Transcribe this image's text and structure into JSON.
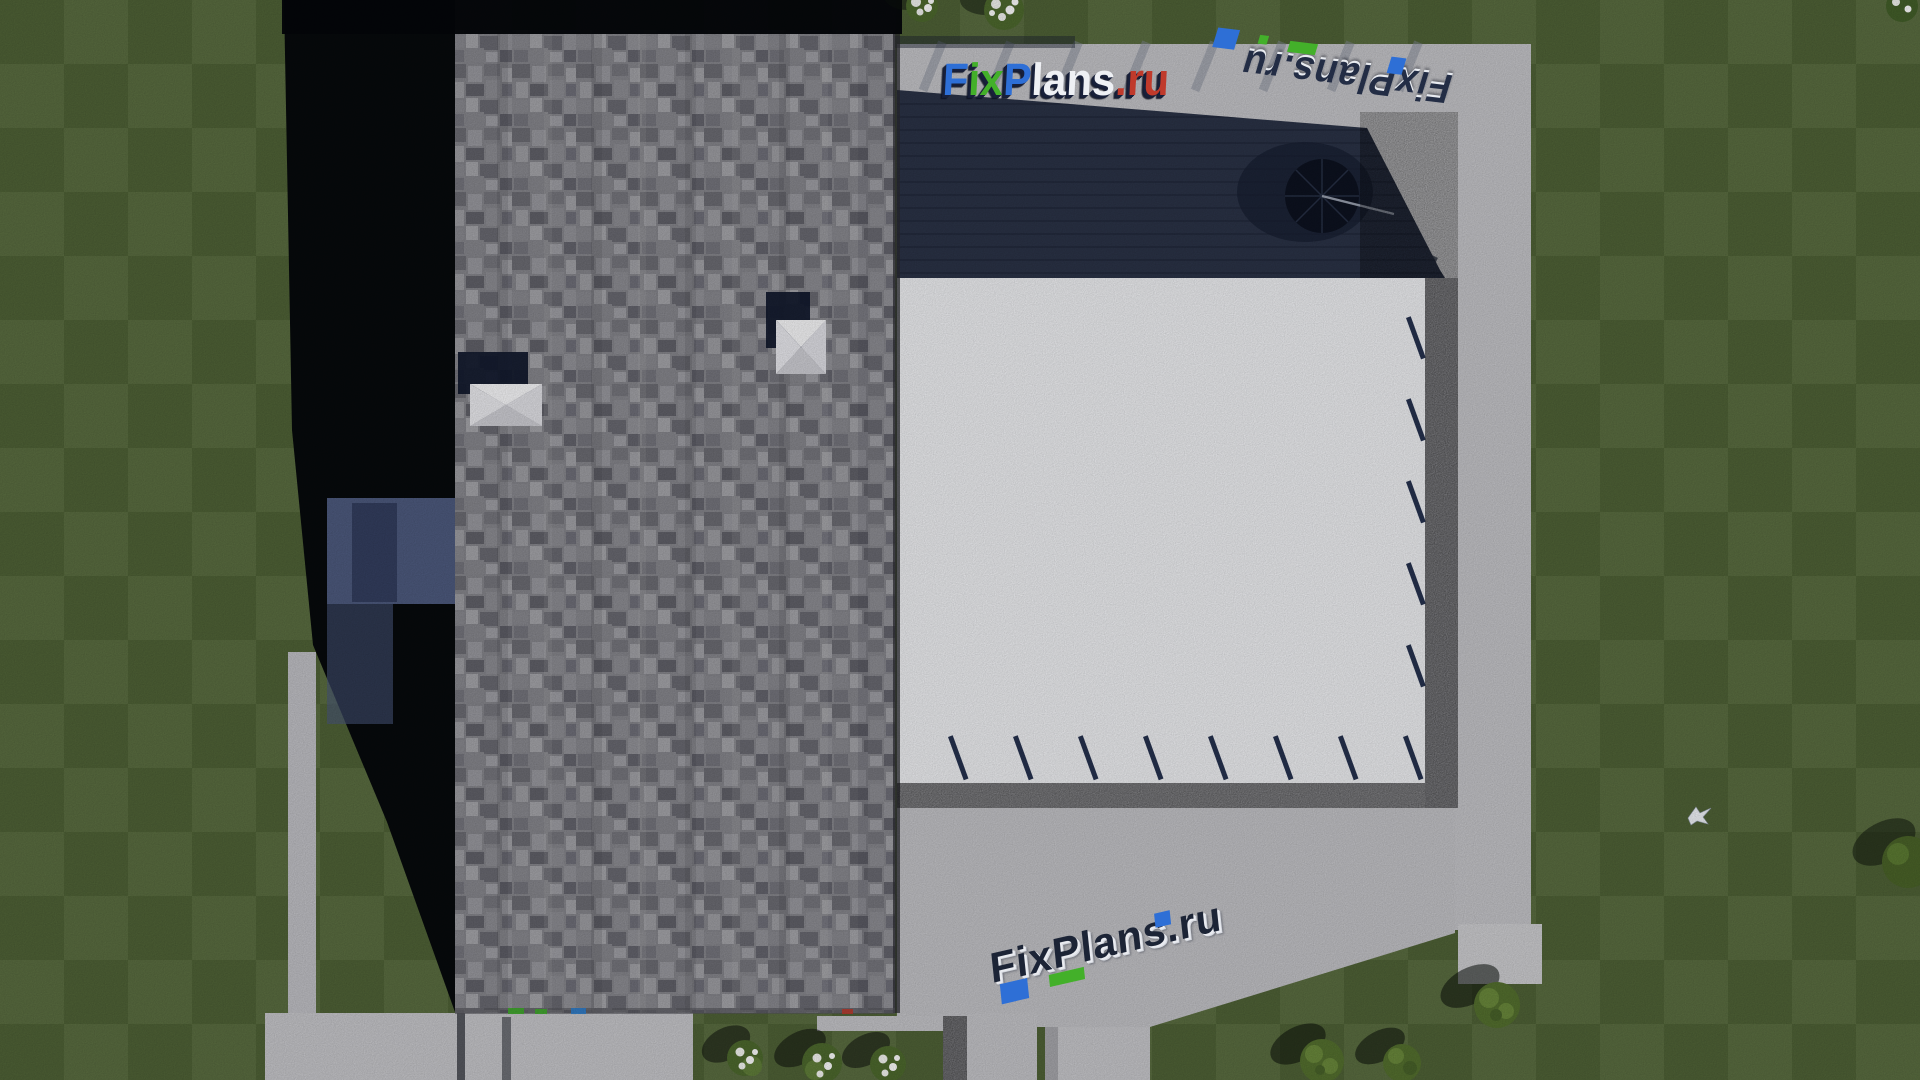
{
  "scene": {
    "type": "aerial-3d-render",
    "description": "Top-down 3D architectural render of a house: gray shingle roof, white terrace, pergola-shaded deck with patio umbrella, concrete paths and patio, striped mowed lawn, bushes and a flying bird",
    "watermarks": {
      "top": {
        "text": "FixPlans.ru",
        "segments": [
          {
            "text": "F",
            "color": "#2e6fd6"
          },
          {
            "text": "ix",
            "color": "#43b02a"
          },
          {
            "text": "P",
            "color": "#2e6fd6"
          },
          {
            "text": "lans",
            "color": "#eef0f4"
          },
          {
            "text": ".ru",
            "color": "#c03a2b"
          }
        ]
      },
      "top_right_mirrored": {
        "text": "FixPlans.ru",
        "color": "#232d45",
        "style": "upside-down 3D reflection, navy with blue and green accent blocks"
      },
      "bottom": {
        "text": "FixPlans.ru",
        "color": "#1c2436",
        "style": "tilted navy 3D letters with white faces, blue and green accent blocks"
      }
    },
    "palette": {
      "grass": "#55693a",
      "grass_dark": "#4c5f33",
      "concrete": "#c6c6ca",
      "concrete_light": "#d2d2d5",
      "terrace_white": "#f0f1f4",
      "roof_gray": "#87878d",
      "shadow_black": "#04060a",
      "pergola_navy": "#2b3347",
      "gravel": "#aeaeb3",
      "accent_blue": "#2e6fd6",
      "accent_green": "#43b02a",
      "accent_red": "#c03a2b",
      "navy": "#18203a"
    },
    "objects": [
      {
        "name": "house-roof",
        "desc": "gray asphalt-shingle roof, rectangular, top view",
        "count": 1
      },
      {
        "name": "roof-vent-skylight",
        "desc": "white pyramid roof vents with navy cast shadows",
        "count": 2
      },
      {
        "name": "white-terrace",
        "desc": "white stucco terrace with navy joist shadows on edges",
        "count": 1
      },
      {
        "name": "pergola-shaded-deck",
        "desc": "dark navy shaded deck area at top of terrace",
        "count": 1
      },
      {
        "name": "patio-umbrella",
        "desc": "dark round umbrella seen from above inside shaded deck",
        "count": 1
      },
      {
        "name": "concrete-patio",
        "desc": "light gray concrete patio and walkways around house",
        "count": 1
      },
      {
        "name": "garden-path",
        "desc": "narrow light path on lawn at left",
        "count": 1
      },
      {
        "name": "house-shadow",
        "desc": "long black shadow cast left of the roof",
        "count": 1
      },
      {
        "name": "flowering-bush",
        "desc": "white flowering shrubs",
        "count": 5
      },
      {
        "name": "green-bush",
        "desc": "green shrubs",
        "count": 4
      },
      {
        "name": "flying-bird",
        "desc": "small white bird over lawn at right",
        "count": 1
      },
      {
        "name": "lawn",
        "desc": "green lawn with checkerboard mowing stripes",
        "count": 1
      }
    ]
  }
}
